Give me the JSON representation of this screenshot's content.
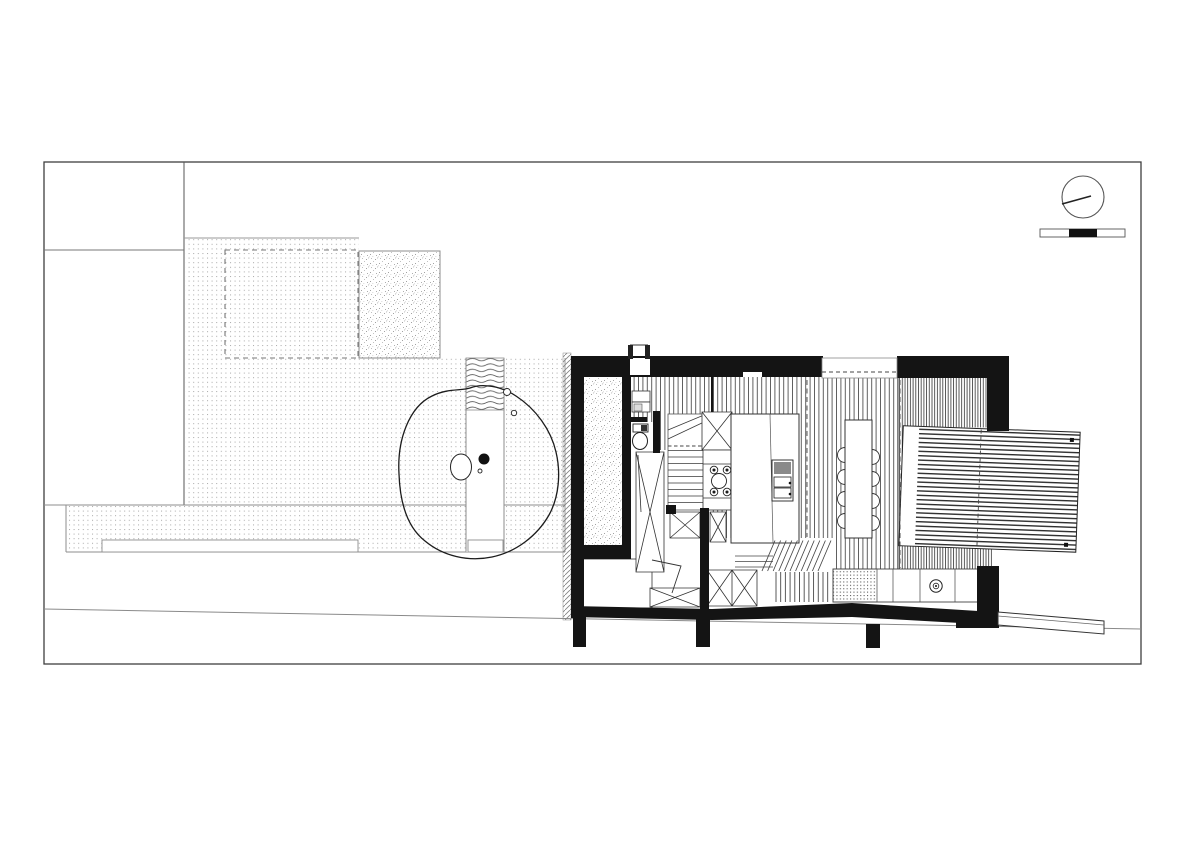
{
  "document": {
    "kind": "architectural site plan with ground floor plan",
    "sheet": {
      "background": "#ffffff",
      "border_color": "#3f3f3f"
    }
  },
  "palette": {
    "paper": "#ffffff",
    "wall_black": "#141414",
    "line_dark": "#2f2f2f",
    "line_mid": "#777777",
    "line_light": "#aaaaaa",
    "hatch": "#4f4f4f",
    "dot_gray": "#a6a6a6"
  },
  "legend": {
    "patterns": [
      {
        "name": "dot-grid",
        "meaning": "paved garden and terrace"
      },
      {
        "name": "speckle",
        "meaning": "gravel courtyard / existing footprint"
      },
      {
        "name": "vertical-hatch",
        "meaning": "interior timber floor"
      },
      {
        "name": "dense-vertical-hatch",
        "meaning": "interior timber floor, east rooms"
      },
      {
        "name": "horizontal-hatch",
        "meaning": "timber deck terrace"
      },
      {
        "name": "wavy-hatch",
        "meaning": "planting / water strip"
      },
      {
        "name": "diagonal-hatch",
        "meaning": "existing boundary wall"
      },
      {
        "name": "solid-black",
        "meaning": "structural walls cut in plan"
      }
    ]
  },
  "aria": {
    "sheet": "drawing sheet border",
    "site": "site plan with garden",
    "garden": "paved garden with dot grid",
    "proposed_outline": "dashed setback outline",
    "outbuilding": "speckled existing footprint",
    "terrace": "lower garden terrace strip",
    "garden_step": "long garden step",
    "path": "garden path with landing",
    "water": "wavy planted strip",
    "tree": "existing tree with canopy and trunk",
    "boundary_wall": "existing boundary wall, diagonal hatch",
    "house": "ground floor plan of house",
    "courtyard": "gravel light-well courtyard",
    "entry": "entry hall with porch",
    "wc": "toilet room",
    "stair": "staircase with winders",
    "kitchen": "kitchen with cooktop and island",
    "island": "kitchen island with sink",
    "dining": "dining table with eight chairs",
    "east_room": "east living room floor",
    "deck": "timber deck terrace",
    "lounge": "lower lounge with shelving",
    "store": "store room",
    "counter": "rear counter with sink",
    "steps": "level-change steps",
    "fence": "low garden wall at street",
    "road": "road edge line",
    "north": "north arrow symbol",
    "scale": "graphic scale bar"
  },
  "symbols": {
    "north_arrow": {
      "shape": "circle with needle"
    },
    "scale_bar": {
      "segments": [
        "white",
        "black",
        "white"
      ],
      "black_segment_index": 1
    }
  },
  "house": {
    "rooms": [
      {
        "name": "entry-hall"
      },
      {
        "name": "wc"
      },
      {
        "name": "courtyard-lightwell"
      },
      {
        "name": "kitchen"
      },
      {
        "name": "dining-area"
      },
      {
        "name": "east-living-room"
      },
      {
        "name": "lower-lounge"
      },
      {
        "name": "store-room"
      }
    ],
    "furniture": [
      {
        "name": "staircase"
      },
      {
        "name": "toilet"
      },
      {
        "name": "entry-closet"
      },
      {
        "name": "wardrobe-x-boxes"
      },
      {
        "name": "cooktop"
      },
      {
        "name": "island-sink"
      },
      {
        "name": "dining-table"
      },
      {
        "name": "dining-chairs",
        "count": 8
      },
      {
        "name": "rear-counter-sink"
      },
      {
        "name": "deck-terrace"
      },
      {
        "name": "steps"
      }
    ]
  }
}
